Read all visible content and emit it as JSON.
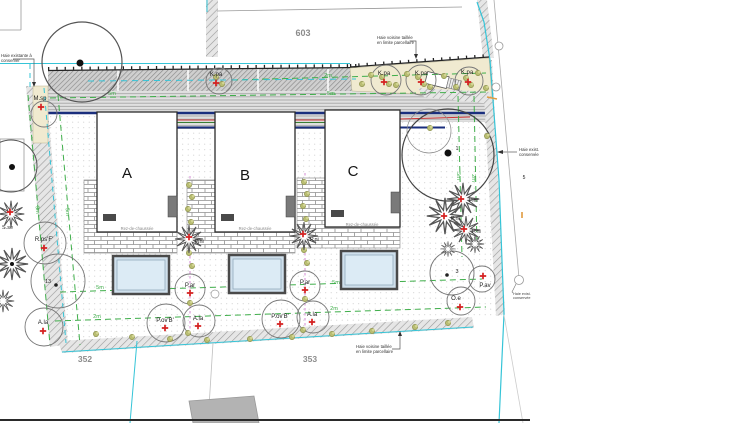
{
  "parcels": {
    "p603": "603",
    "p352": "352",
    "p353": "353"
  },
  "buildings": {
    "a": "A",
    "b": "B",
    "c": "C",
    "floor": "Rez-de-chaussée"
  },
  "plants": {
    "kpa": "K.pa",
    "msp": "M.sp",
    "rpsf": "R.ps'F'",
    "ala": "A.la",
    "par": "P.ar",
    "povb": "P.ov'B'",
    "pav": "P.av",
    "oe": "O.e",
    "pni": "P.ni",
    "sse": "S.se"
  },
  "numbers": {
    "n1": "1",
    "n3": "3",
    "n13": "13",
    "n5": "5"
  },
  "dims": {
    "d2": "2m",
    "d5": "5m",
    "d3": "3m"
  },
  "notes": {
    "left1": "Haie existante à",
    "left2": "conserver",
    "top1": "Haie voisine taillée",
    "top2": "en limite parcellaire",
    "bottom1": "Haie voisine taillée",
    "bottom2": "en limite parcellaire",
    "right1": "Haie exist.",
    "right2": "conservée",
    "pole1": "Haie exist.",
    "pole2": "conservée"
  },
  "colors": {
    "boundary_cyan": "#35c4d7",
    "offset_green": "#3fae4a",
    "marker_red": "#d42020",
    "pool_water": "#cfe0ec",
    "utility_navy": "#1b2f7d"
  }
}
